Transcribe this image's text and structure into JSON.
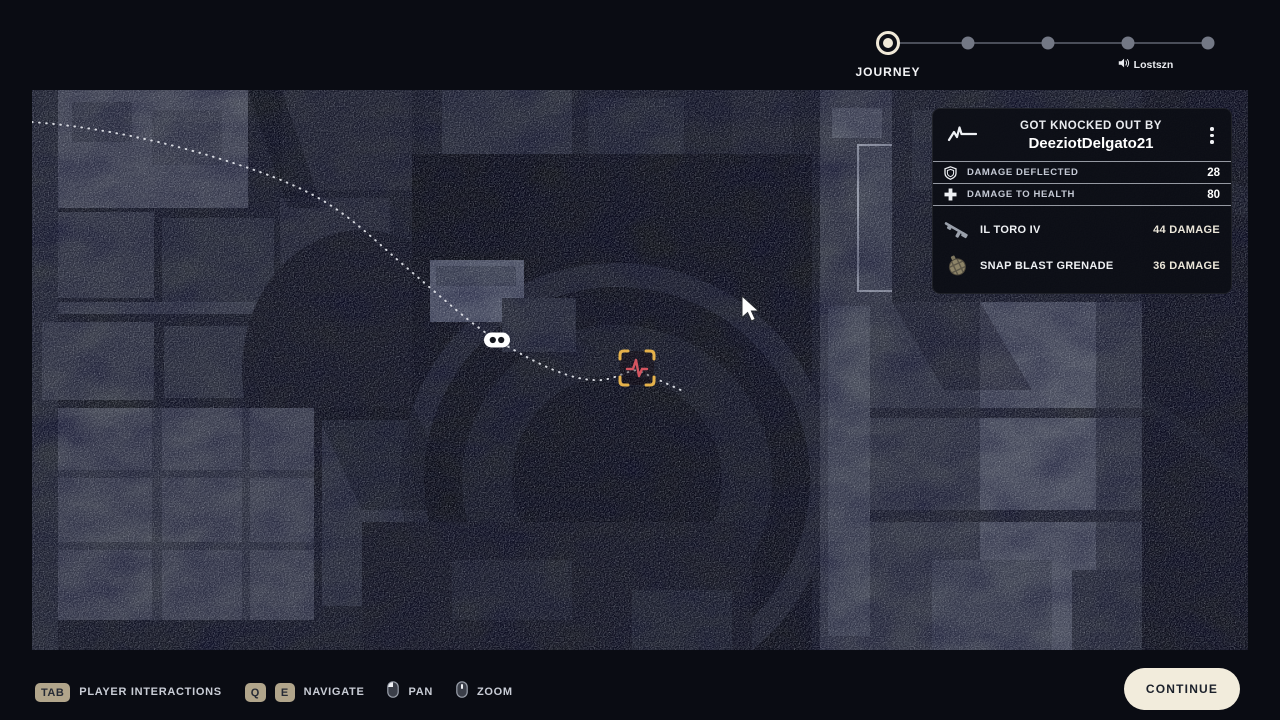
{
  "stepper": {
    "active_label": "JOURNEY",
    "audio_label": "Lostszn",
    "step_count": 5,
    "active_index": 0,
    "audio_index": 3
  },
  "knockout_panel": {
    "header_icon": "pulse-icon",
    "title": "GOT KNOCKED OUT BY",
    "player_name": "DeeziotDelgato21",
    "menu_icon": "kebab-menu-icon",
    "stats": [
      {
        "icon": "shield-icon",
        "label": "DAMAGE DEFLECTED",
        "value": "28"
      },
      {
        "icon": "health-cross-icon",
        "label": "DAMAGE TO HEALTH",
        "value": "80"
      }
    ],
    "weapons": [
      {
        "icon": "rifle-icon",
        "name": "IL TORO IV",
        "damage": "44 DAMAGE"
      },
      {
        "icon": "grenade-icon",
        "name": "SNAP BLAST GRENADE",
        "damage": "36 DAMAGE"
      }
    ]
  },
  "map": {
    "markers": [
      {
        "icon": "downed-player-marker"
      },
      {
        "icon": "knockout-event-marker"
      }
    ],
    "trail": "dotted-player-path"
  },
  "footer": {
    "hints": [
      {
        "keys": [
          "TAB"
        ],
        "label": "PLAYER INTERACTIONS"
      },
      {
        "keys": [
          "Q",
          "E"
        ],
        "label": "NAVIGATE"
      },
      {
        "icon": "mouse-pan-icon",
        "label": "PAN"
      },
      {
        "icon": "mouse-zoom-icon",
        "label": "ZOOM"
      }
    ],
    "continue_label": "CONTINUE"
  },
  "colors": {
    "background": "#0a0c13",
    "cream": "#f2ecdc",
    "key_tan": "#b1a58b",
    "bracket_gold": "#e5b14a",
    "pulse_red": "#d4545f"
  }
}
